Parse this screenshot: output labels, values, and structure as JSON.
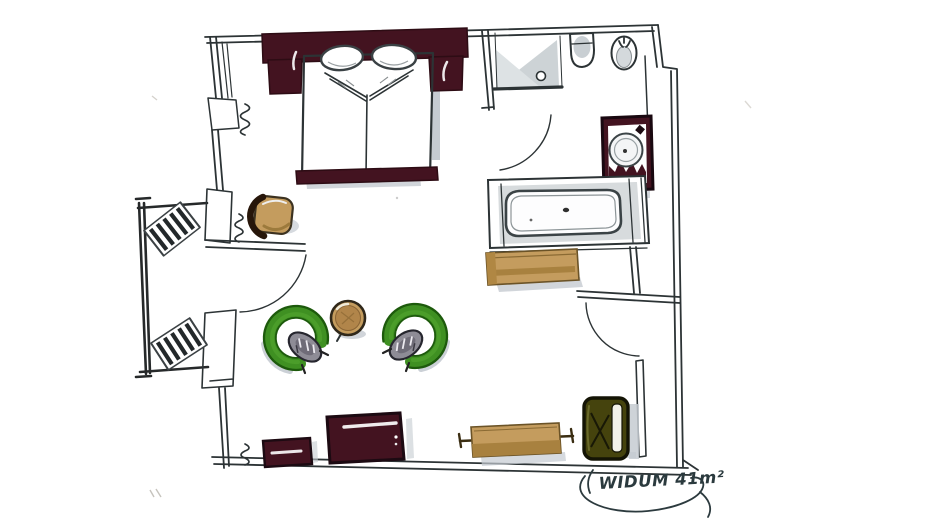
{
  "floor_plan": {
    "room_label": {
      "text": "WIDUM 41m²",
      "room_name": "WIDUM",
      "area": "41 m²"
    },
    "rooms": [
      "bedroom-living-area",
      "bathroom",
      "balcony",
      "entry-nook"
    ],
    "furniture": [
      "double-bed",
      "desk-chair",
      "side-table",
      "armchair-left",
      "armchair-right",
      "sideboard",
      "bench",
      "dresser",
      "minibar-cabinet",
      "luggage-rack",
      "deck-chair-1",
      "deck-chair-2"
    ],
    "fixtures": [
      "shower",
      "toilet",
      "bidet",
      "washbasin-vanity",
      "bathtub",
      "radiator-window",
      "radiator-wall",
      "radiator-bottom"
    ],
    "doors": [
      "balcony-french-door",
      "bathroom-door",
      "entry-door"
    ],
    "colors": {
      "ink": "#2c3335",
      "maroon": "#431320",
      "tan": "#c49c5e",
      "tan_dark": "#a8813f",
      "green": "#3f9022",
      "green_dark": "#1d5a0c",
      "olive": "#45430d",
      "cushion_gray": "#8e8c96",
      "shadow_gray": "#c5cbd1",
      "paper": "#ffffff"
    }
  }
}
